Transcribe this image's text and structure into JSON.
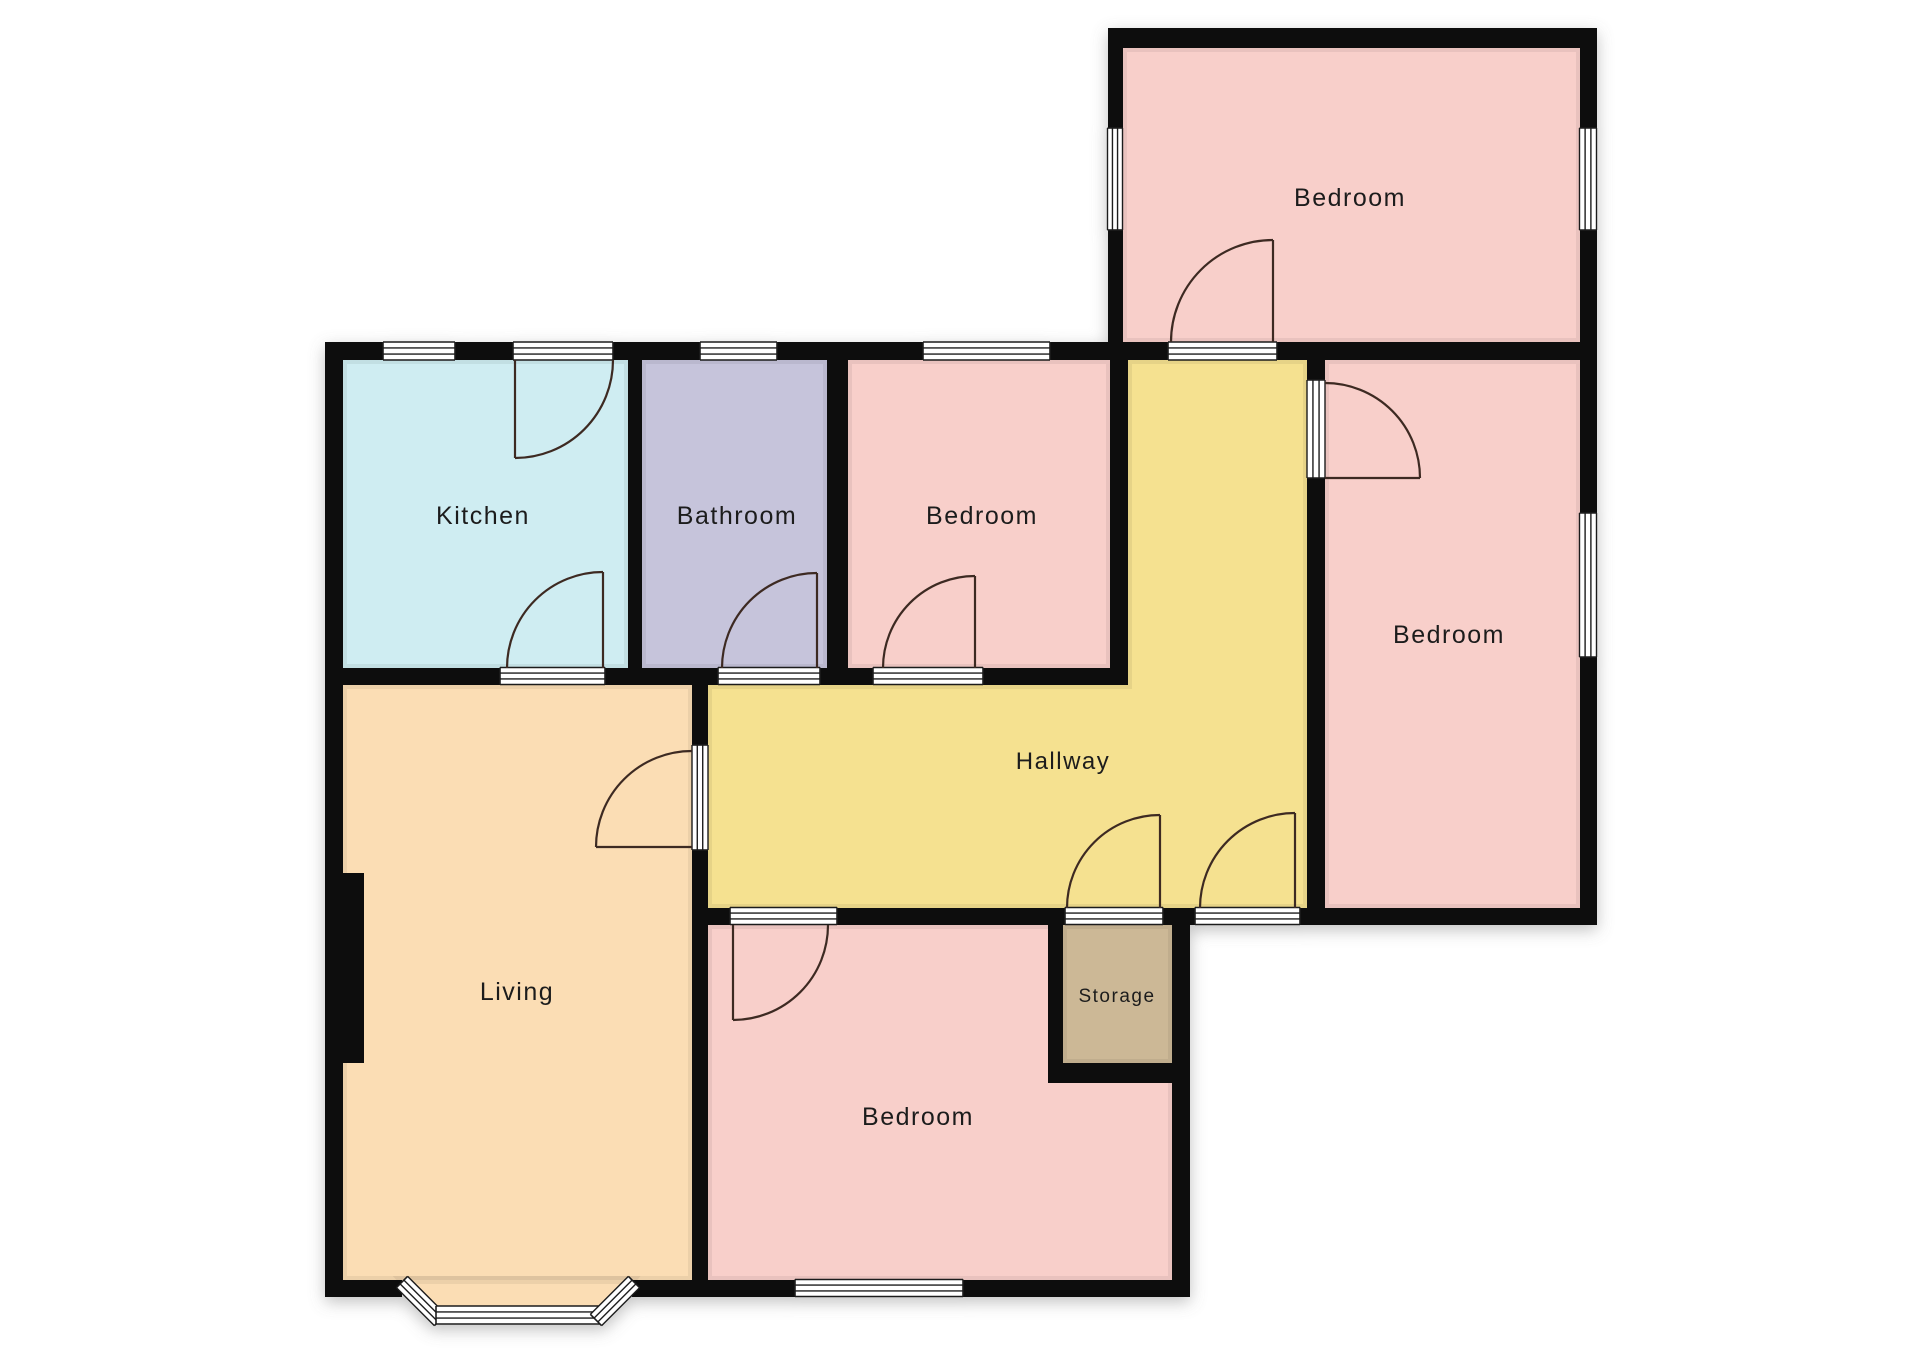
{
  "page": {
    "background": "#ffffff"
  },
  "floorplan": {
    "canvas": {
      "width": 1920,
      "height": 1358
    },
    "palette": {
      "wall": "#0e0e0e",
      "bar_fill": "#ffffff",
      "bar_line": "#1c1c1c",
      "door_line": "#3e2a23",
      "label": "#1e1e1e",
      "pink": "#f8cfca",
      "cyan": "#cfedf2",
      "lavender": "#c6c4db",
      "yellow": "#f5e190",
      "peach": "#fbddb4",
      "tan": "#ccb896"
    },
    "rooms": [
      {
        "name": "bedroom-top",
        "label": "Bedroom",
        "fill": "#f8cfca",
        "rect": [
          1123,
          48,
          457,
          294
        ],
        "label_xy": [
          1350,
          206
        ],
        "font": 25
      },
      {
        "name": "kitchen",
        "label": "Kitchen",
        "fill": "#cfedf2",
        "rect": [
          343,
          360,
          285,
          308
        ],
        "label_xy": [
          483,
          524
        ],
        "font": 25
      },
      {
        "name": "bathroom",
        "label": "Bathroom",
        "fill": "#c6c4db",
        "rect": [
          642,
          360,
          185,
          308
        ],
        "label_xy": [
          737,
          524
        ],
        "font": 25
      },
      {
        "name": "bedroom-middle",
        "label": "Bedroom",
        "fill": "#f8cfca",
        "rect": [
          848,
          360,
          262,
          308
        ],
        "label_xy": [
          982,
          524
        ],
        "font": 25
      },
      {
        "name": "bedroom-right",
        "label": "Bedroom",
        "fill": "#f8cfca",
        "rect": [
          1325,
          360,
          255,
          548
        ],
        "label_xy": [
          1449,
          643
        ],
        "font": 25
      },
      {
        "name": "hallway",
        "label": "Hallway",
        "fill": "#f5e190",
        "poly": [
          [
            708,
            685
          ],
          [
            1128,
            685
          ],
          [
            1128,
            360
          ],
          [
            1307,
            360
          ],
          [
            1307,
            908
          ],
          [
            708,
            908
          ]
        ],
        "label_xy": [
          1063,
          769
        ],
        "font": 24
      },
      {
        "name": "living",
        "label": "Living",
        "fill": "#fbddb4",
        "rect": [
          343,
          685,
          349,
          595
        ],
        "label_xy": [
          517,
          1000
        ],
        "font": 25
      },
      {
        "name": "bedroom-bottom",
        "label": "Bedroom",
        "fill": "#f8cfca",
        "rect": [
          708,
          925,
          464,
          355
        ],
        "label_xy": [
          918,
          1125
        ],
        "font": 25
      },
      {
        "name": "storage",
        "label": "Storage",
        "fill": "#ccb896",
        "rect": [
          1063,
          925,
          109,
          138
        ],
        "label_xy": [
          1117,
          1002
        ],
        "font": 19
      },
      {
        "name": "living-bay-floor",
        "label": null,
        "fill": "#fbddb4",
        "poly": [
          [
            402,
            1280
          ],
          [
            632,
            1280
          ],
          [
            600,
            1318
          ],
          [
            438,
            1318
          ]
        ]
      }
    ],
    "walls": [
      [
        1108,
        28,
        489,
        20
      ],
      [
        1108,
        28,
        15,
        314
      ],
      [
        1580,
        28,
        17,
        897
      ],
      [
        325,
        342,
        1272,
        18
      ],
      [
        325,
        342,
        18,
        955
      ],
      [
        628,
        358,
        14,
        310
      ],
      [
        827,
        358,
        21,
        310
      ],
      [
        1110,
        358,
        18,
        327
      ],
      [
        325,
        668,
        803,
        17
      ],
      [
        692,
        668,
        16,
        629
      ],
      [
        1307,
        360,
        18,
        563
      ],
      [
        692,
        908,
        905,
        17
      ],
      [
        1048,
        925,
        15,
        158
      ],
      [
        1048,
        1063,
        142,
        20
      ],
      [
        1172,
        908,
        18,
        389
      ],
      [
        325,
        1280,
        77,
        17
      ],
      [
        632,
        1280,
        76,
        17
      ],
      [
        692,
        1280,
        498,
        17
      ],
      [
        340,
        873,
        24,
        190
      ]
    ],
    "openings": [
      {
        "name": "window-kitchen",
        "kind": "window",
        "p1": [
          383,
          351
        ],
        "p2": [
          455,
          351
        ],
        "th": 18
      },
      {
        "name": "doorway-kitchen-exterior",
        "kind": "door",
        "p1": [
          513,
          351
        ],
        "p2": [
          613,
          351
        ],
        "th": 18
      },
      {
        "name": "window-bathroom",
        "kind": "window",
        "p1": [
          700,
          351
        ],
        "p2": [
          777,
          351
        ],
        "th": 18
      },
      {
        "name": "window-bedroom-middle",
        "kind": "window",
        "p1": [
          923,
          351
        ],
        "p2": [
          1050,
          351
        ],
        "th": 18
      },
      {
        "name": "doorway-bedroom-top",
        "kind": "door",
        "p1": [
          1168,
          351
        ],
        "p2": [
          1277,
          351
        ],
        "th": 18
      },
      {
        "name": "window-bedroom-top-left",
        "kind": "window",
        "p1": [
          1115,
          128
        ],
        "p2": [
          1115,
          230
        ],
        "th": 15
      },
      {
        "name": "window-bedroom-top-right",
        "kind": "window",
        "p1": [
          1588,
          128
        ],
        "p2": [
          1588,
          230
        ],
        "th": 17
      },
      {
        "name": "window-bedroom-right",
        "kind": "window",
        "p1": [
          1588,
          513
        ],
        "p2": [
          1588,
          657
        ],
        "th": 17
      },
      {
        "name": "doorway-kitchen-living",
        "kind": "door",
        "p1": [
          500,
          676
        ],
        "p2": [
          605,
          676
        ],
        "th": 17
      },
      {
        "name": "doorway-bathroom",
        "kind": "door",
        "p1": [
          718,
          676
        ],
        "p2": [
          820,
          676
        ],
        "th": 17
      },
      {
        "name": "doorway-bedroom-middle",
        "kind": "door",
        "p1": [
          873,
          676
        ],
        "p2": [
          983,
          676
        ],
        "th": 17
      },
      {
        "name": "doorway-living",
        "kind": "door",
        "p1": [
          700,
          745
        ],
        "p2": [
          700,
          850
        ],
        "th": 16
      },
      {
        "name": "doorway-bedroom-right",
        "kind": "door",
        "p1": [
          1316,
          380
        ],
        "p2": [
          1316,
          478
        ],
        "th": 18
      },
      {
        "name": "doorway-bedroom-bottom",
        "kind": "door",
        "p1": [
          730,
          916
        ],
        "p2": [
          837,
          916
        ],
        "th": 17
      },
      {
        "name": "doorway-storage",
        "kind": "door",
        "p1": [
          1065,
          916
        ],
        "p2": [
          1163,
          916
        ],
        "th": 17
      },
      {
        "name": "doorway-front-entrance",
        "kind": "door",
        "p1": [
          1195,
          916
        ],
        "p2": [
          1300,
          916
        ],
        "th": 17
      },
      {
        "name": "window-bedroom-bottom",
        "kind": "window",
        "p1": [
          795,
          1288
        ],
        "p2": [
          963,
          1288
        ],
        "th": 17
      },
      {
        "name": "window-bay-left",
        "kind": "window",
        "p1": [
          402,
          1282
        ],
        "p2": [
          440,
          1320
        ],
        "th": 16
      },
      {
        "name": "window-bay-center",
        "kind": "window",
        "p1": [
          436,
          1315
        ],
        "p2": [
          600,
          1315
        ],
        "th": 18
      },
      {
        "name": "window-bay-right",
        "kind": "window",
        "p1": [
          596,
          1320
        ],
        "p2": [
          634,
          1282
        ],
        "th": 16
      }
    ],
    "doors": [
      {
        "name": "door-kitchen-exterior",
        "hinge": [
          515,
          360
        ],
        "r": 98,
        "a0": 0,
        "a1": 90
      },
      {
        "name": "door-kitchen-living",
        "hinge": [
          603,
          668
        ],
        "r": 96,
        "a0": 180,
        "a1": 270
      },
      {
        "name": "door-bathroom",
        "hinge": [
          817,
          668
        ],
        "r": 95,
        "a0": 180,
        "a1": 270
      },
      {
        "name": "door-bedroom-middle",
        "hinge": [
          975,
          668
        ],
        "r": 92,
        "a0": 180,
        "a1": 270
      },
      {
        "name": "door-bedroom-top",
        "hinge": [
          1273,
          342
        ],
        "r": 102,
        "a0": 180,
        "a1": 270
      },
      {
        "name": "door-bedroom-right",
        "hinge": [
          1325,
          478
        ],
        "r": 95,
        "a0": 270,
        "a1": 360
      },
      {
        "name": "door-living",
        "hinge": [
          692,
          847
        ],
        "r": 96,
        "a0": 270,
        "a1": 180
      },
      {
        "name": "door-bedroom-bottom",
        "hinge": [
          733,
          925
        ],
        "r": 95,
        "a0": 0,
        "a1": 90
      },
      {
        "name": "door-storage",
        "hinge": [
          1160,
          908
        ],
        "r": 93,
        "a0": 180,
        "a1": 270
      },
      {
        "name": "door-front-entrance",
        "hinge": [
          1295,
          908
        ],
        "r": 95,
        "a0": 180,
        "a1": 270
      }
    ]
  }
}
